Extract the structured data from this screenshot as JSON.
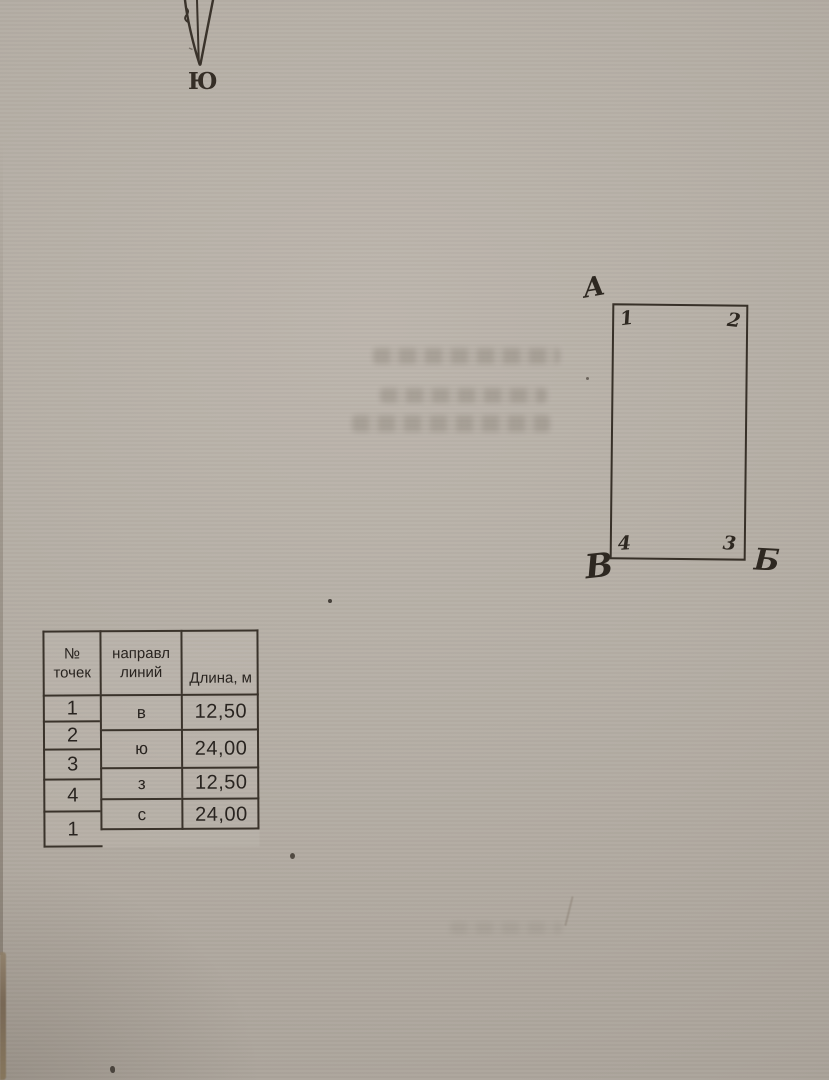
{
  "compass": {
    "south_label": "Ю"
  },
  "sketch": {
    "outer_labels": {
      "top_left": "А",
      "bottom_left": "В",
      "bottom_right": "Б"
    },
    "corner_numbers": {
      "top_left": "1",
      "top_right": "2",
      "bottom_right": "3",
      "bottom_left": "4"
    }
  },
  "table": {
    "headers": {
      "points": "№\nточек",
      "direction": "направл\nлиний",
      "length": "Длина, м"
    },
    "points": [
      "1",
      "2",
      "3",
      "4",
      "1"
    ],
    "directions": [
      "в",
      "ю",
      "з",
      "с"
    ],
    "lengths": [
      "12,50",
      "24,00",
      "12,50",
      "24,00"
    ]
  },
  "colors": {
    "paper": "#b4ada4",
    "ink": "#373028",
    "print_text": "#292420"
  }
}
